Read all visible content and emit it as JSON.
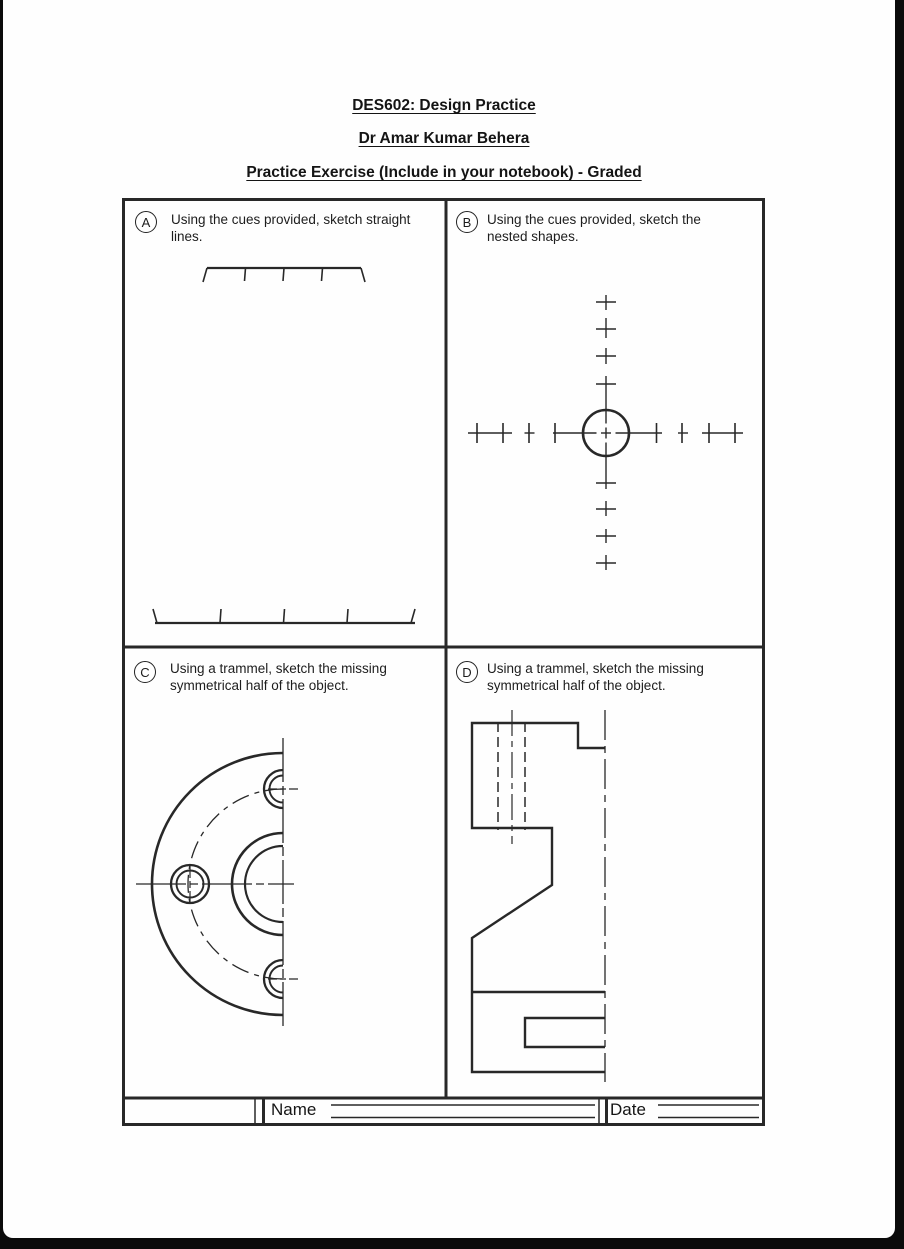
{
  "page": {
    "titles": {
      "course": "DES602: Design Practice",
      "author": "Dr Amar Kumar Behera",
      "exercise": "Practice Exercise (Include in your notebook) - Graded"
    }
  },
  "panels": [
    {
      "label": "A",
      "caption_lines": [
        "Using the cues provided, sketch straight",
        "lines."
      ]
    },
    {
      "label": "B",
      "caption_lines": [
        "Using the cues provided, sketch the",
        "nested shapes."
      ]
    },
    {
      "label": "C",
      "caption_lines": [
        "Using a trammel, sketch the missing",
        "symmetrical half of the object."
      ]
    },
    {
      "label": "D",
      "caption_lines": [
        "Using a trammel, sketch the missing",
        "symmetrical half of the object."
      ]
    }
  ],
  "footer": {
    "name_label": "Name",
    "date_label": "Date"
  },
  "colors": {
    "ink": "#282828",
    "paper": "#fefefe",
    "surround": "#0b0b0b"
  }
}
